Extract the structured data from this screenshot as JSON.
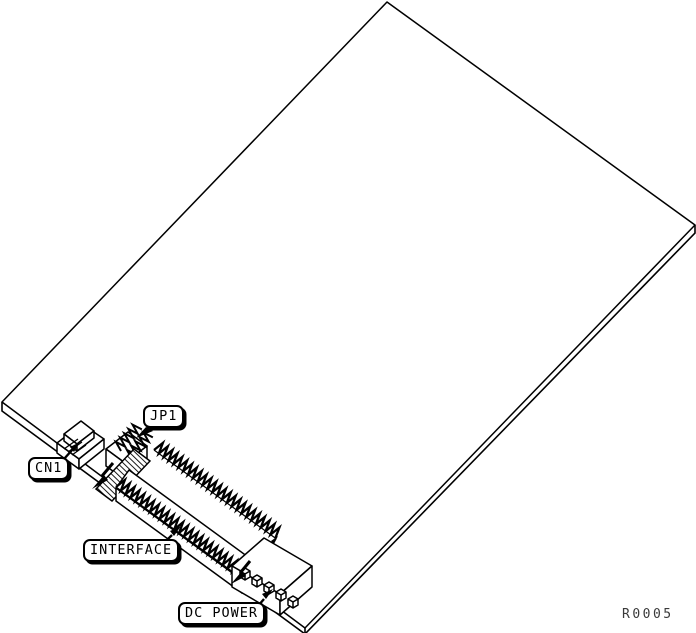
{
  "diagram": {
    "description": "Line-art hardware figure of a circuit board in perspective with labeled connectors",
    "callouts": [
      {
        "id": "jp1",
        "label": "JP1"
      },
      {
        "id": "cn1",
        "label": "CN1"
      },
      {
        "id": "interface",
        "label": "INTERFACE"
      },
      {
        "id": "dc_power",
        "label": "DC POWER"
      }
    ],
    "reference_code": "R0005",
    "colors": {
      "line": "#000000",
      "background": "#ffffff",
      "label_background": "#ffffff",
      "reference_text": "#3a3a3a"
    }
  }
}
